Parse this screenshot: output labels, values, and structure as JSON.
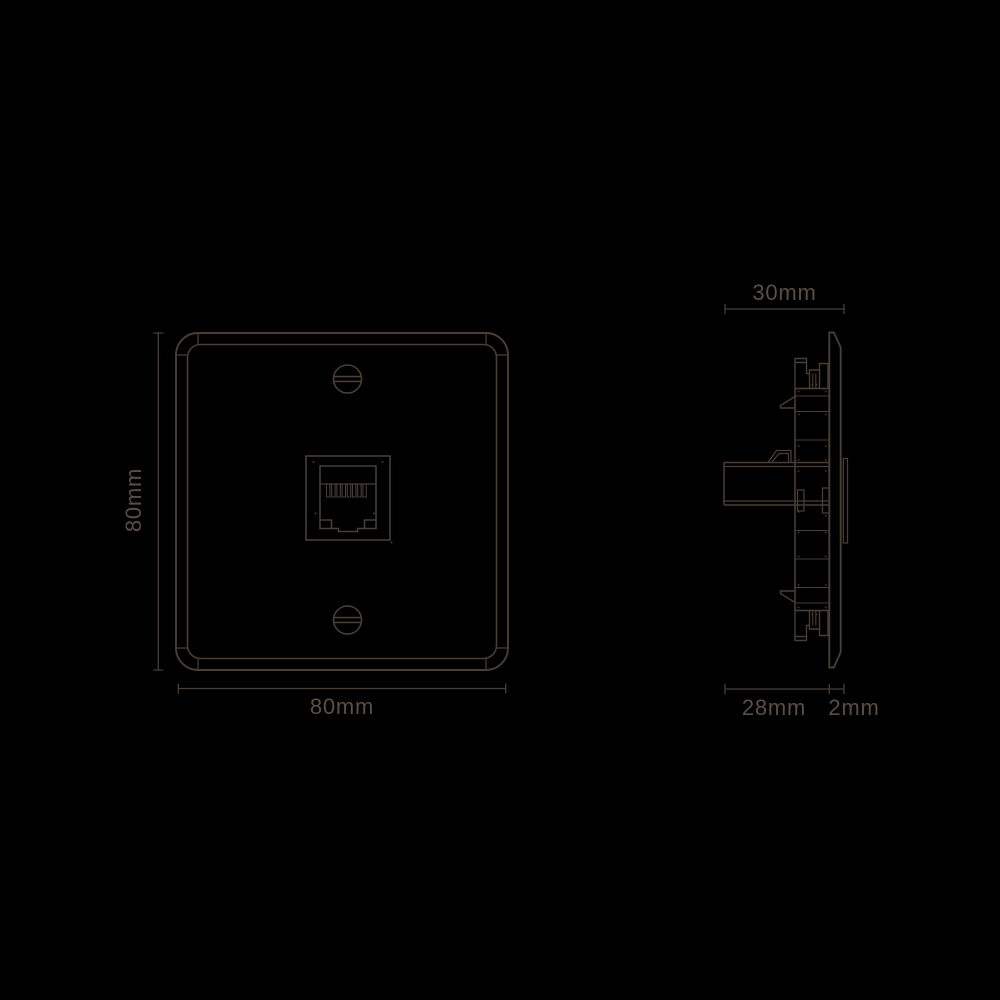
{
  "page": {
    "background_color": "#000000",
    "line_color": "#493d34",
    "text_color": "#5b4e45"
  },
  "drawing": {
    "subject": "single-gang telephone/data socket wall plate, front and side elevation",
    "front_view": {
      "height_label": "80mm",
      "width_label": "80mm"
    },
    "side_view": {
      "overall_depth_label": "30mm",
      "mechanism_depth_label": "28mm",
      "plate_thickness_label": "2mm"
    }
  }
}
